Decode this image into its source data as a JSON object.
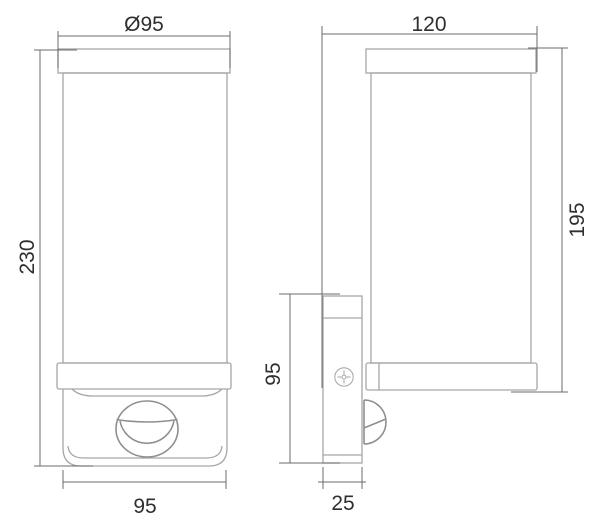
{
  "drawing": {
    "type": "technical-dimension-drawing",
    "views": {
      "front_view": {
        "dimensions": {
          "top_diameter": "Ø95",
          "overall_height": "230",
          "base_width": "95"
        }
      },
      "side_view": {
        "dimensions": {
          "overall_depth": "120",
          "lamp_height": "195",
          "bracket_height": "95",
          "bracket_depth": "25"
        }
      }
    },
    "colors": {
      "background": "#ffffff",
      "object_outline": "#a6a6a6",
      "object_detail": "#8f8f8f",
      "dimension_lines": "#6b6b6b",
      "dimension_text": "#2f2f2f"
    }
  }
}
